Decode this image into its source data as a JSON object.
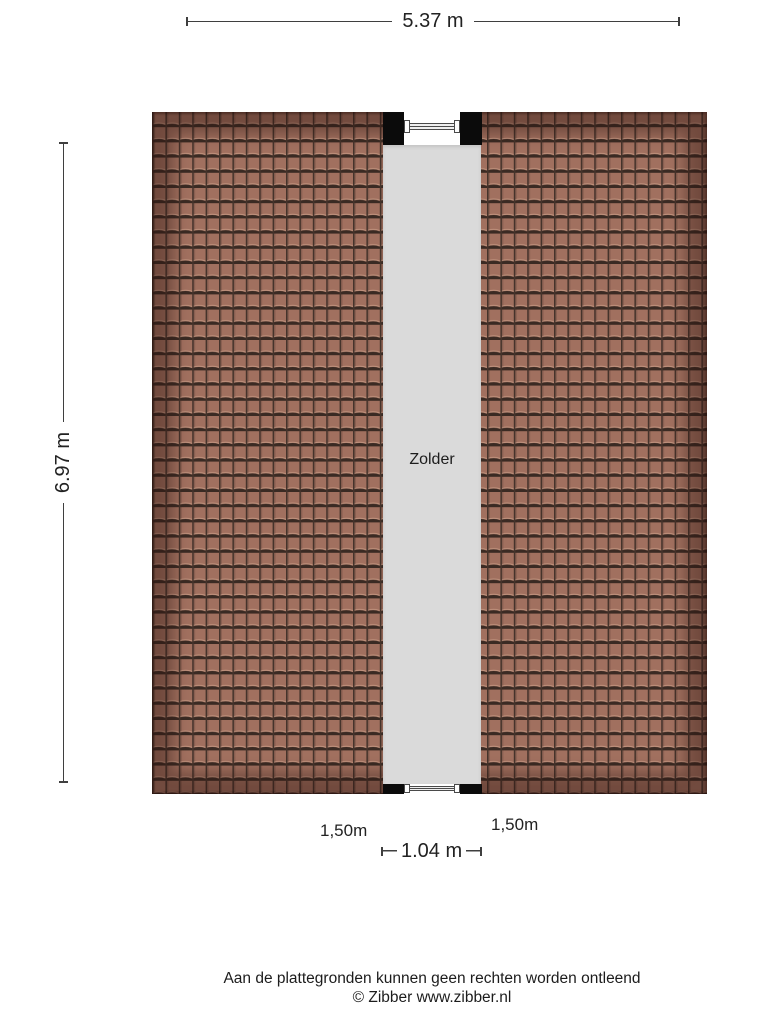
{
  "room": {
    "label": "Zolder"
  },
  "dimensions": {
    "width_total": "5.37 m",
    "height_total": "6.97 m",
    "opening_width": "1.04 m",
    "clearance_left": "1,50m",
    "clearance_right": "1,50m"
  },
  "footer": {
    "disclaimer": "Aan de plattegronden kunnen geen rechten worden ontleend",
    "copyright": "© Zibber www.zibber.nl"
  },
  "colors": {
    "roof_tile": "#a1705f",
    "roof_tile_dark": "#3a2a23",
    "roof_ridge": "#45332b",
    "floor": "#dadada",
    "wall": "#0b0b0b",
    "line": "#3f3f3f",
    "text": "#222222",
    "background": "#ffffff"
  }
}
